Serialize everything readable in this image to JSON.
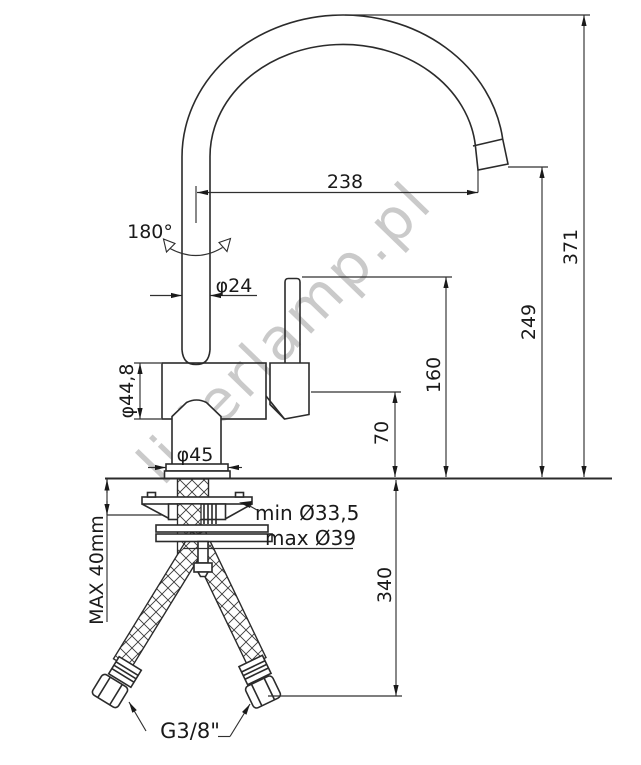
{
  "title": "Kitchen faucet technical drawing",
  "watermark": "liderlamp.pl",
  "dims": {
    "spout_reach": "238",
    "rotation": "180°",
    "spout_tube_dia": "φ24",
    "body_dia": "φ44,8",
    "base_dia": "φ45",
    "total_height": "371",
    "outlet_height": "249",
    "lever_height": "160",
    "body_height": "70",
    "hose_length": "340",
    "hole_min": "min Ø33,5",
    "hole_max": "max Ø39",
    "deck_thickness": "MAX 40mm",
    "thread": "G3/8\""
  },
  "colors": {
    "line": "#2b2b2b",
    "dimension": "#303030",
    "watermark": "#bdbdbd",
    "background": "#ffffff"
  }
}
